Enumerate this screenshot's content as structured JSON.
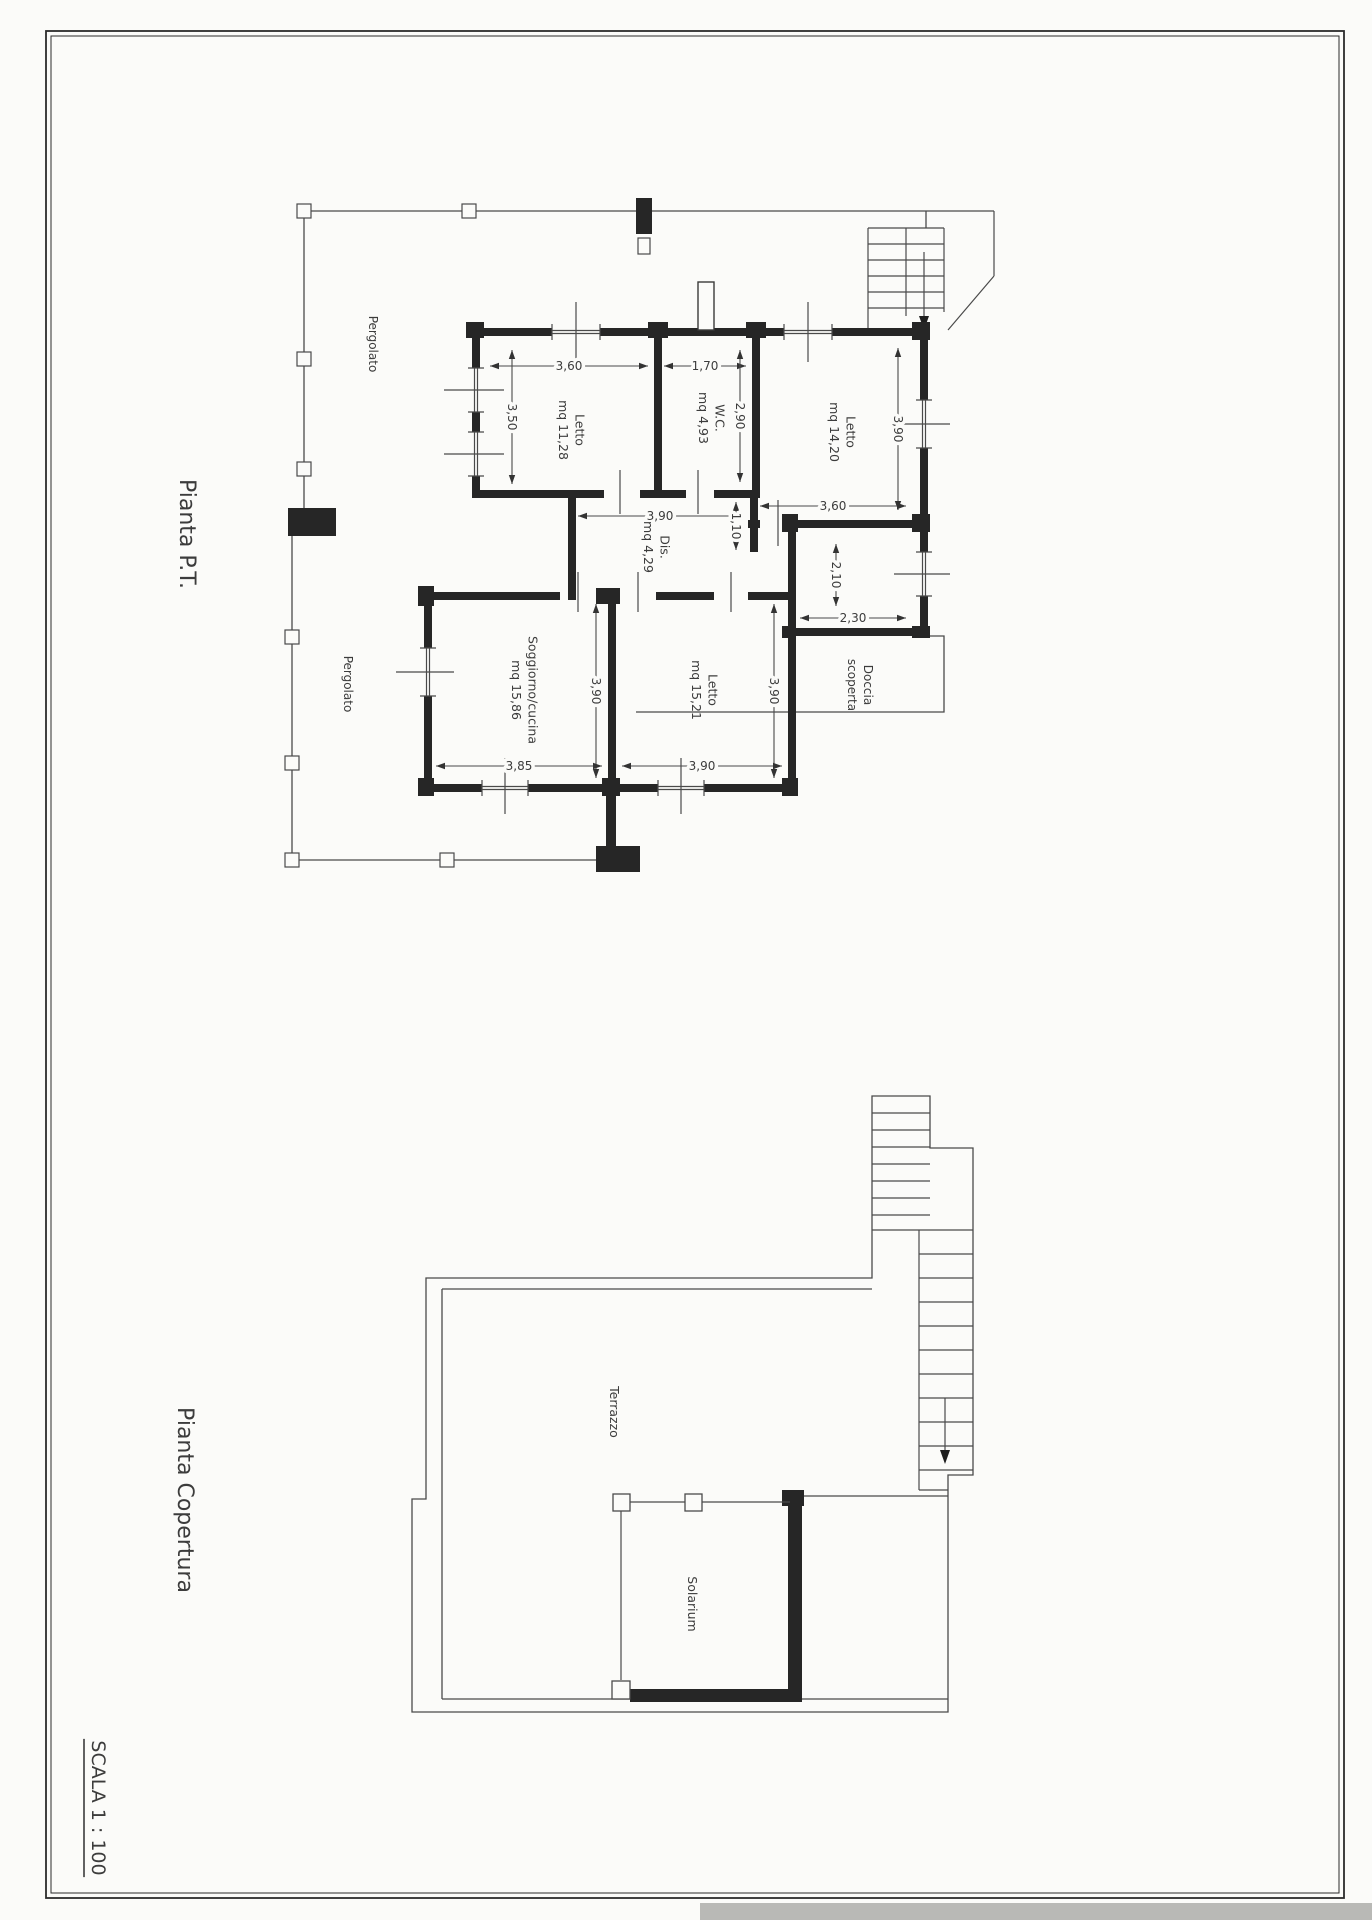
{
  "page": {
    "paper_color": "#fbfbf9",
    "line_color": "#4a4a4a",
    "wall_color": "#262626",
    "text_color": "#3c3c3c",
    "scale_label": "SCALA 1 : 100"
  },
  "plans": {
    "ground": {
      "title": "Pianta P.T.",
      "rooms": [
        {
          "name": "Letto",
          "area": "mq 11,28"
        },
        {
          "name": "W.C.",
          "area": "mq 4,93"
        },
        {
          "name": "Letto",
          "area": "mq 14,20"
        },
        {
          "name": "Dis.",
          "area": "mq 4,29"
        },
        {
          "name": "Soggiorno/cucina",
          "area": "mq 15,86"
        },
        {
          "name": "Letto",
          "area": "mq 15,21"
        }
      ],
      "outdoor_areas": [
        "Pergolato",
        "Pergolato",
        "Doccia scoperta"
      ],
      "dimension_values": [
        "3,60",
        "1,70",
        "3,50",
        "2,90",
        "3,90",
        "3,60",
        "3,90",
        "1,10",
        "3,90",
        "3,90",
        "3,85",
        "3,90",
        "2,10",
        "2,30"
      ]
    },
    "roof": {
      "title": "Pianta Copertura",
      "areas": [
        "Terrazzo",
        "Solarium"
      ]
    }
  },
  "drawing": {
    "labels": [
      {
        "name": "ground-plan-title",
        "text": "Pianta P.T.",
        "x": 180,
        "y": 534,
        "size": 22,
        "rot": 90
      },
      {
        "name": "roof-plan-title",
        "text": "Pianta Copertura",
        "x": 178,
        "y": 1500,
        "size": 22,
        "rot": 90
      },
      {
        "name": "scale-label",
        "text": "SCALA 1 : 100",
        "x": 92,
        "y": 1808,
        "size": 19,
        "rot": 90,
        "underline": true
      },
      {
        "name": "room-label-letto-1",
        "lines": [
          "Letto",
          "mq 11,28"
        ],
        "x": 567,
        "y": 430,
        "size": 12.5,
        "rot": 90
      },
      {
        "name": "room-label-wc",
        "lines": [
          "W.C.",
          "mq 4,93"
        ],
        "x": 707,
        "y": 418,
        "size": 12.5,
        "rot": 90
      },
      {
        "name": "room-label-letto-2",
        "lines": [
          "Letto",
          "mq 14,20"
        ],
        "x": 838,
        "y": 432,
        "size": 12.5,
        "rot": 90
      },
      {
        "name": "room-label-dis",
        "lines": [
          "Dis.",
          "mq 4,29"
        ],
        "x": 652,
        "y": 547,
        "size": 12.5,
        "rot": 90
      },
      {
        "name": "room-label-soggiorno",
        "lines": [
          "Soggiorno/cucina",
          "mq 15,86"
        ],
        "x": 520,
        "y": 690,
        "size": 12.5,
        "rot": 90
      },
      {
        "name": "room-label-letto-3",
        "lines": [
          "Letto",
          "mq 15,21"
        ],
        "x": 700,
        "y": 690,
        "size": 12.5,
        "rot": 90
      },
      {
        "name": "outdoor-label-doccia",
        "lines": [
          "Doccia",
          "scoperta"
        ],
        "x": 856,
        "y": 685,
        "size": 12,
        "rot": 90
      },
      {
        "name": "outdoor-label-pergolato-1",
        "text": "Pergolato",
        "x": 369,
        "y": 344,
        "size": 12,
        "rot": 90
      },
      {
        "name": "outdoor-label-pergolato-2",
        "text": "Pergolato",
        "x": 344,
        "y": 684,
        "size": 12,
        "rot": 90
      },
      {
        "name": "roof-label-terrazzo",
        "text": "Terrazzo",
        "x": 610,
        "y": 1412,
        "size": 12.5,
        "rot": 90
      },
      {
        "name": "roof-label-solarium",
        "text": "Solarium",
        "x": 688,
        "y": 1604,
        "size": 12.5,
        "rot": 90
      }
    ],
    "dimensions": [
      {
        "name": "dim-letto1-width",
        "value": "3,60",
        "dir": "h",
        "x1": 490,
        "x2": 648,
        "y": 366
      },
      {
        "name": "dim-wc-width",
        "value": "1,70",
        "dir": "h",
        "x1": 664,
        "x2": 746,
        "y": 366
      },
      {
        "name": "dim-letto1-height",
        "value": "3,50",
        "dir": "v",
        "x": 512,
        "y1": 350,
        "y2": 484
      },
      {
        "name": "dim-wc-height",
        "value": "2,90",
        "dir": "v",
        "x": 740,
        "y1": 350,
        "y2": 482
      },
      {
        "name": "dim-letto2-height",
        "value": "3,90",
        "dir": "v",
        "x": 898,
        "y1": 348,
        "y2": 510
      },
      {
        "name": "dim-letto2-width",
        "value": "3,60",
        "dir": "h",
        "x1": 760,
        "x2": 906,
        "y": 506
      },
      {
        "name": "dim-corridor-width",
        "value": "3,90",
        "dir": "h",
        "x1": 578,
        "x2": 742,
        "y": 516
      },
      {
        "name": "dim-corridor-niche",
        "value": "1,10",
        "dir": "v",
        "x": 736,
        "y1": 502,
        "y2": 550
      },
      {
        "name": "dim-soggiorno-height",
        "value": "3,90",
        "dir": "v",
        "x": 596,
        "y1": 604,
        "y2": 778
      },
      {
        "name": "dim-letto3-height",
        "value": "3,90",
        "dir": "v",
        "x": 774,
        "y1": 604,
        "y2": 778
      },
      {
        "name": "dim-soggiorno-width",
        "value": "3,85",
        "dir": "h",
        "x1": 436,
        "x2": 602,
        "y": 766
      },
      {
        "name": "dim-letto3-width",
        "value": "3,90",
        "dir": "h",
        "x1": 622,
        "x2": 782,
        "y": 766
      },
      {
        "name": "dim-smallroom-height",
        "value": "2,10",
        "dir": "v",
        "x": 836,
        "y1": 544,
        "y2": 606
      },
      {
        "name": "dim-smallroom-width",
        "value": "2,30",
        "dir": "h",
        "x1": 800,
        "x2": 906,
        "y": 618
      }
    ]
  }
}
